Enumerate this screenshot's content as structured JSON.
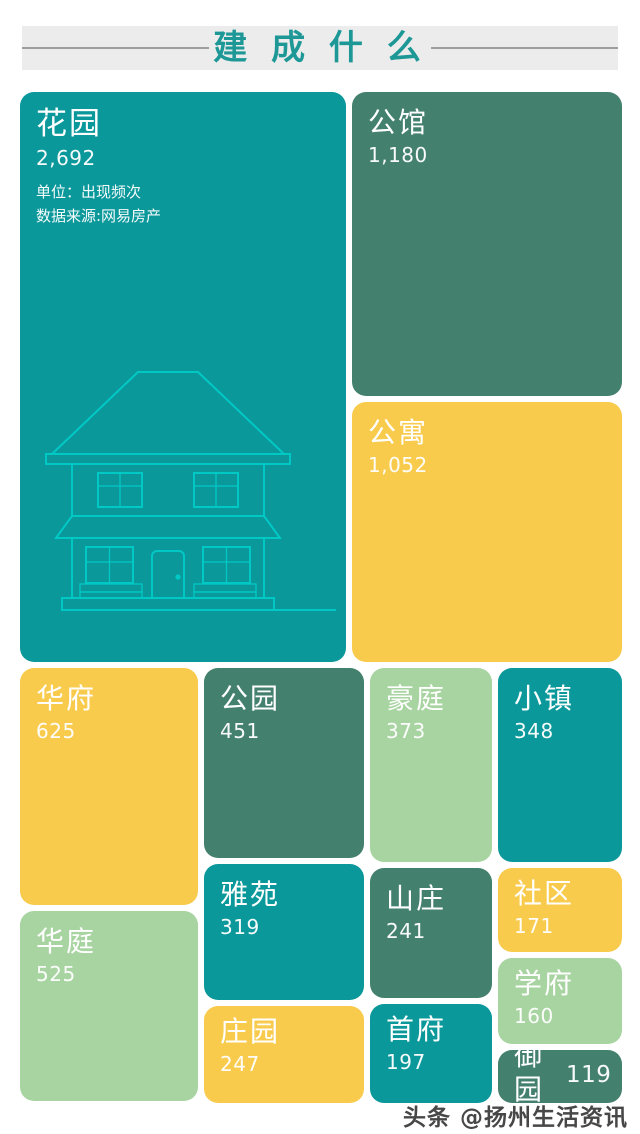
{
  "header": {
    "title": "建 成 什 么"
  },
  "footer": {
    "watermark": "头条 @扬州生活资讯"
  },
  "colors": {
    "teal": "#0B989B",
    "dark_green": "#44806E",
    "yellow": "#F8CB4D",
    "light_green": "#A8D4A1",
    "title_text": "#1E9896",
    "title_band_bg": "#ECECEC",
    "house_line": "#00C9C5",
    "watermark_text": "#474747",
    "background": "#FFFFFF"
  },
  "chart_data": {
    "type": "treemap",
    "title": "建成什么",
    "unit_note": "单位：出现频次",
    "source_note": "数据来源:网易房产",
    "legend_position": "none",
    "items": [
      {
        "label": "花园",
        "value": 2692,
        "value_text": "2,692",
        "color": "#0B989B"
      },
      {
        "label": "公馆",
        "value": 1180,
        "value_text": "1,180",
        "color": "#44806E"
      },
      {
        "label": "公寓",
        "value": 1052,
        "value_text": "1,052",
        "color": "#F8CB4D"
      },
      {
        "label": "华府",
        "value": 625,
        "value_text": "625",
        "color": "#F8CB4D"
      },
      {
        "label": "华庭",
        "value": 525,
        "value_text": "525",
        "color": "#A8D4A1"
      },
      {
        "label": "公园",
        "value": 451,
        "value_text": "451",
        "color": "#44806E"
      },
      {
        "label": "豪庭",
        "value": 373,
        "value_text": "373",
        "color": "#A8D4A1"
      },
      {
        "label": "小镇",
        "value": 348,
        "value_text": "348",
        "color": "#0B989B"
      },
      {
        "label": "雅苑",
        "value": 319,
        "value_text": "319",
        "color": "#0B989B"
      },
      {
        "label": "庄园",
        "value": 247,
        "value_text": "247",
        "color": "#F8CB4D"
      },
      {
        "label": "山庄",
        "value": 241,
        "value_text": "241",
        "color": "#44806E"
      },
      {
        "label": "首府",
        "value": 197,
        "value_text": "197",
        "color": "#0B989B"
      },
      {
        "label": "社区",
        "value": 171,
        "value_text": "171",
        "color": "#F8CB4D"
      },
      {
        "label": "学府",
        "value": 160,
        "value_text": "160",
        "color": "#A8D4A1"
      },
      {
        "label": "御园",
        "value": 119,
        "value_text": "119",
        "color": "#44806E"
      }
    ]
  }
}
